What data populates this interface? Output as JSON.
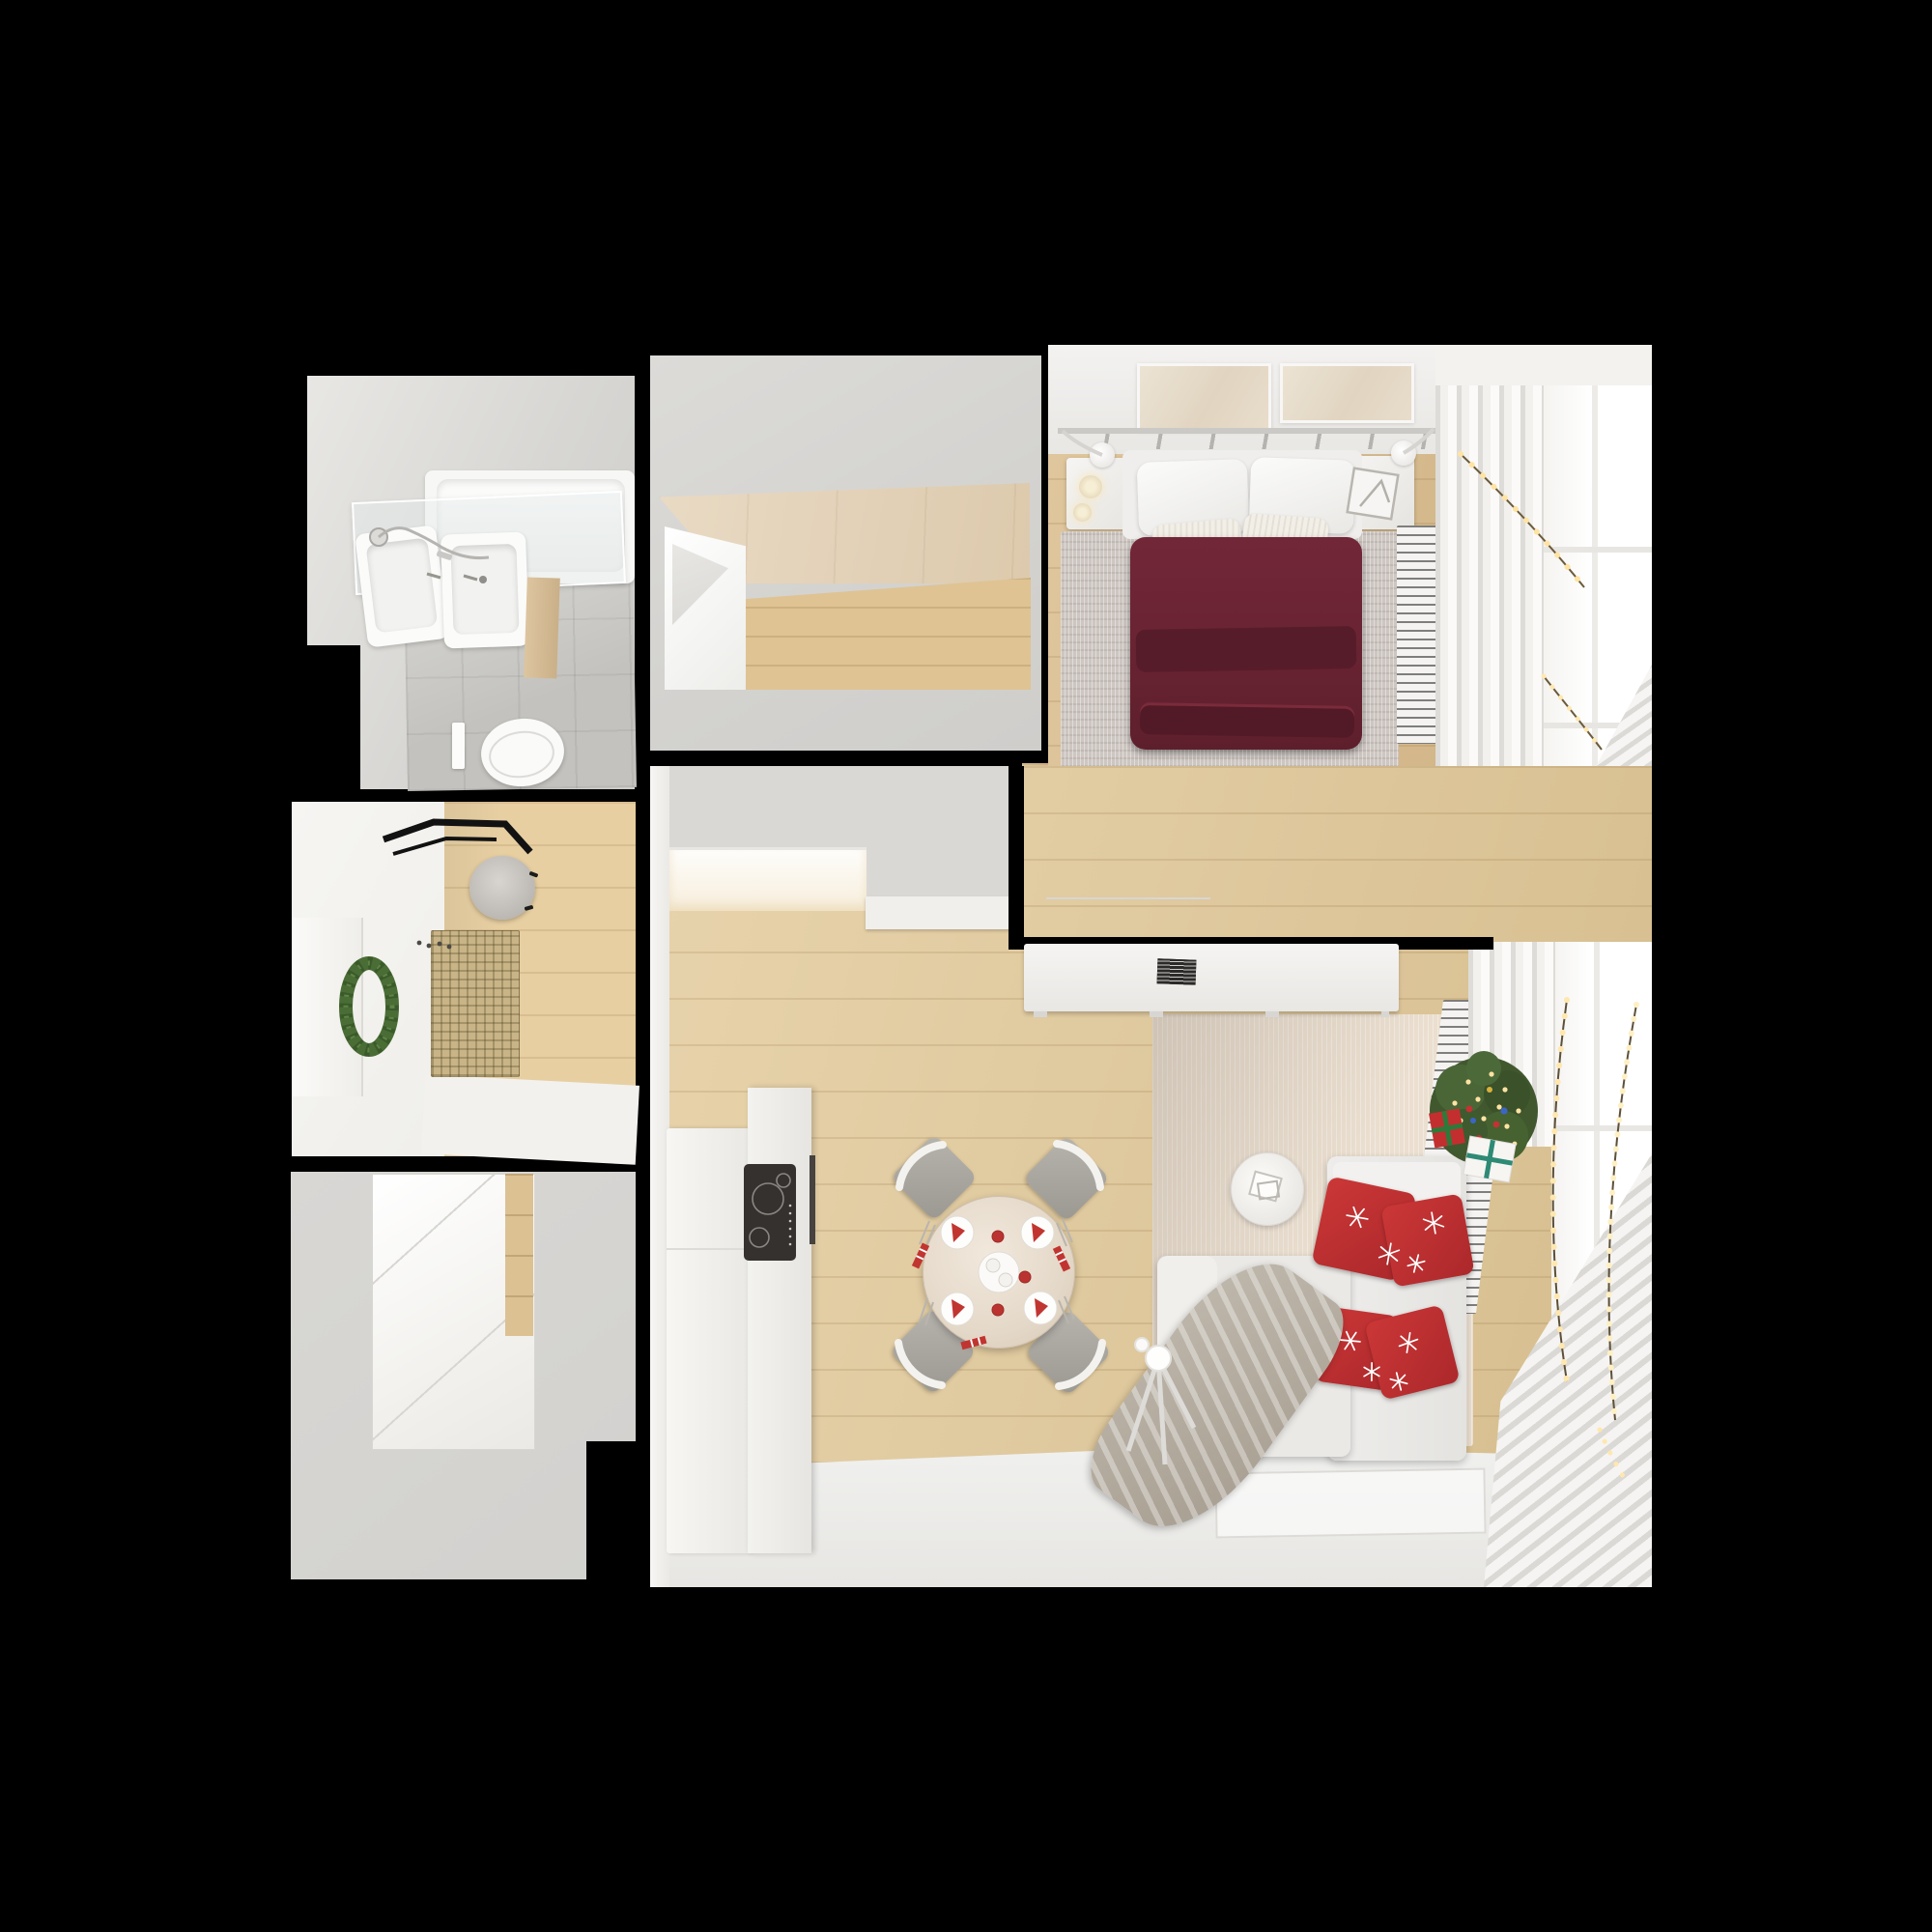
{
  "scene": {
    "title": "Top-down 3D render of a one-bedroom apartment decorated for Christmas",
    "view": "orthographic top view, dollhouse style, black background",
    "background": "#000000"
  },
  "palette": {
    "background": "#000000",
    "wall_gray": "#d4d3d0",
    "wall_white": "#f2f1ee",
    "wood_floor": "#e1c795",
    "wood_bedroom": "#d9ba88",
    "tile_gray": "#c3c2be",
    "duvet_maroon": "#6a2433",
    "pillow_red": "#c23232",
    "rug_living_beige": "#ebdfd0",
    "rug_bedroom_gray": "#cdc6c1",
    "tree_green": "#41582f",
    "wreath_green": "#4a6d36",
    "garland_light_warm": "#ffe3a3",
    "throw_taupe": "#b0a89b",
    "cooktop_black": "#34312e"
  },
  "rooms": [
    {
      "name": "bathroom",
      "items": [
        "bathtub",
        "glass shower screen",
        "double sink vanity with mirror",
        "shower hand set",
        "wall-hung toilet",
        "flush plate",
        "gray tile floor"
      ]
    },
    {
      "name": "wardrobe-room",
      "items": [
        "white closet unit",
        "wood laminate panels",
        "wood floor"
      ]
    },
    {
      "name": "bedroom",
      "items": [
        "double bed with maroon duvet",
        "two white pillows",
        "three textured accent pillows",
        "white headboard with rail and two wall lamps",
        "two wall art panels",
        "left nightstand with candles",
        "right nightstand with picture frame",
        "gray textured rug",
        "white bench",
        "radiator",
        "white curtains",
        "window with string lights garland"
      ]
    },
    {
      "name": "entry-hall",
      "items": [
        "black coat rack",
        "round gray pouf",
        "woven beige doormat",
        "white door with green christmas wreath",
        "coat hooks",
        "wood floor"
      ]
    },
    {
      "name": "storage-room",
      "items": [
        "white closet inset with sliding doors",
        "wood accent panel"
      ]
    },
    {
      "name": "living-kitchen",
      "items": [
        "kitchen counter",
        "black induction cooktop",
        "oven handle",
        "round festive dining table",
        "four gray chairs",
        "four place settings with red napkins",
        "red cups",
        "center serving tray",
        "white corner sofa",
        "four red snowflake cushions",
        "taupe knit throw",
        "round side table with white decor",
        "christmas tree with lights and ornaments",
        "red gift box",
        "white gift box",
        "floor lamp",
        "beige rug",
        "white floor rug",
        "radiator",
        "white curtains",
        "windows with string light garlands",
        "sideboard with black decor object",
        "illuminated wall niche"
      ]
    }
  ]
}
